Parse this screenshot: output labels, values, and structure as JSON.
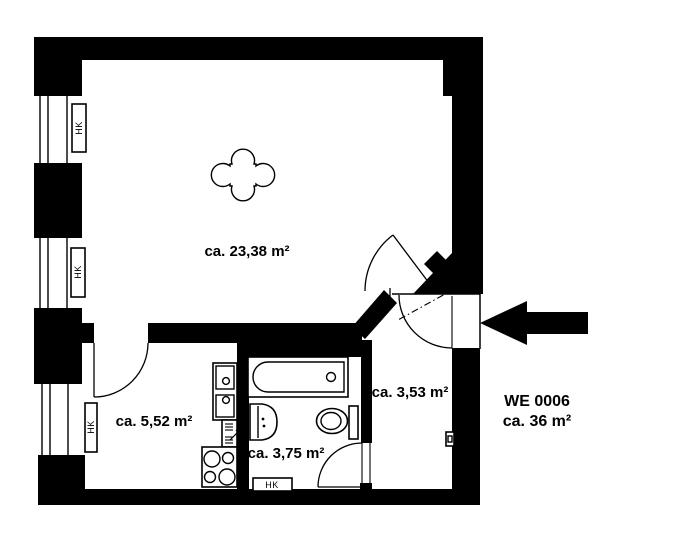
{
  "floor_plan": {
    "unit": {
      "id_label": "WE 0006",
      "area_label": "ca. 36 m²"
    },
    "rooms": [
      {
        "id": "living-room",
        "area_label": "ca. 23,38 m²"
      },
      {
        "id": "kitchen-room",
        "area_label": "ca. 5,52 m²"
      },
      {
        "id": "bathroom",
        "area_label": "ca. 3,75 m²"
      },
      {
        "id": "hallway",
        "area_label": "ca. 3,53 m²"
      }
    ],
    "radiator_label": "HK",
    "colors": {
      "wall": "#000000",
      "background": "#ffffff",
      "text": "#000000"
    }
  }
}
